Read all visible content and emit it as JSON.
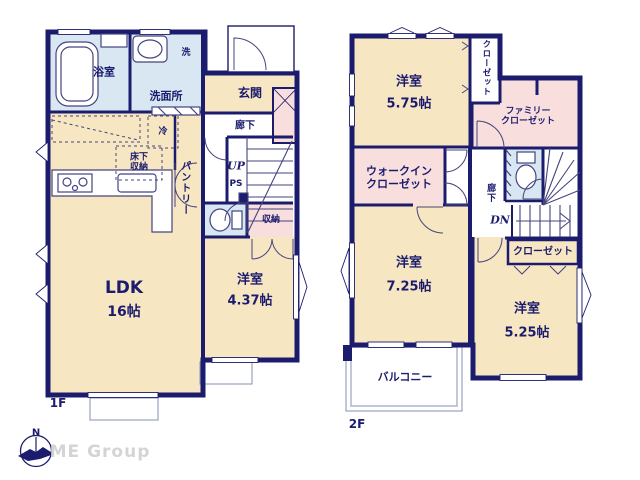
{
  "floor1": {
    "label": "1F",
    "bathroom": "浴室",
    "washroom": "洗面所",
    "laundry": "洗",
    "entrance": "玄関",
    "hallway": "廊下",
    "stairs_up": "UP",
    "pipe_space": "PS",
    "pantry": "パントリー",
    "fridge": "冷",
    "underfloor_storage_l1": "床下",
    "underfloor_storage_l2": "収納",
    "storage": "収納",
    "ldk_name": "LDK",
    "ldk_size": "16帖",
    "bedroom_name": "洋室",
    "bedroom_size": "4.37帖"
  },
  "floor2": {
    "label": "2F",
    "bedroom1_name": "洋室",
    "bedroom1_size": "5.75帖",
    "closet_top": "クローゼット",
    "family_closet_l1": "ファミリー",
    "family_closet_l2": "クローゼット",
    "wic_l1": "ウォークイン",
    "wic_l2": "クローゼット",
    "hallway": "廊下",
    "stairs_down": "DN",
    "closet": "クローゼット",
    "bedroom2_name": "洋室",
    "bedroom2_size": "7.25帖",
    "bedroom3_name": "洋室",
    "bedroom3_size": "5.25帖",
    "balcony": "バルコニー"
  },
  "branding": {
    "compass_north": "N",
    "logo": "ME Group"
  },
  "colors": {
    "navy": "#1c1c6e",
    "cream": "#f7e6c2",
    "pink": "#f9dede",
    "blue": "#d9e7f3",
    "thin": "#44447f",
    "grayline": "#9aa2c0",
    "brand": "#d4d4d4",
    "paper": "#ffffff"
  }
}
